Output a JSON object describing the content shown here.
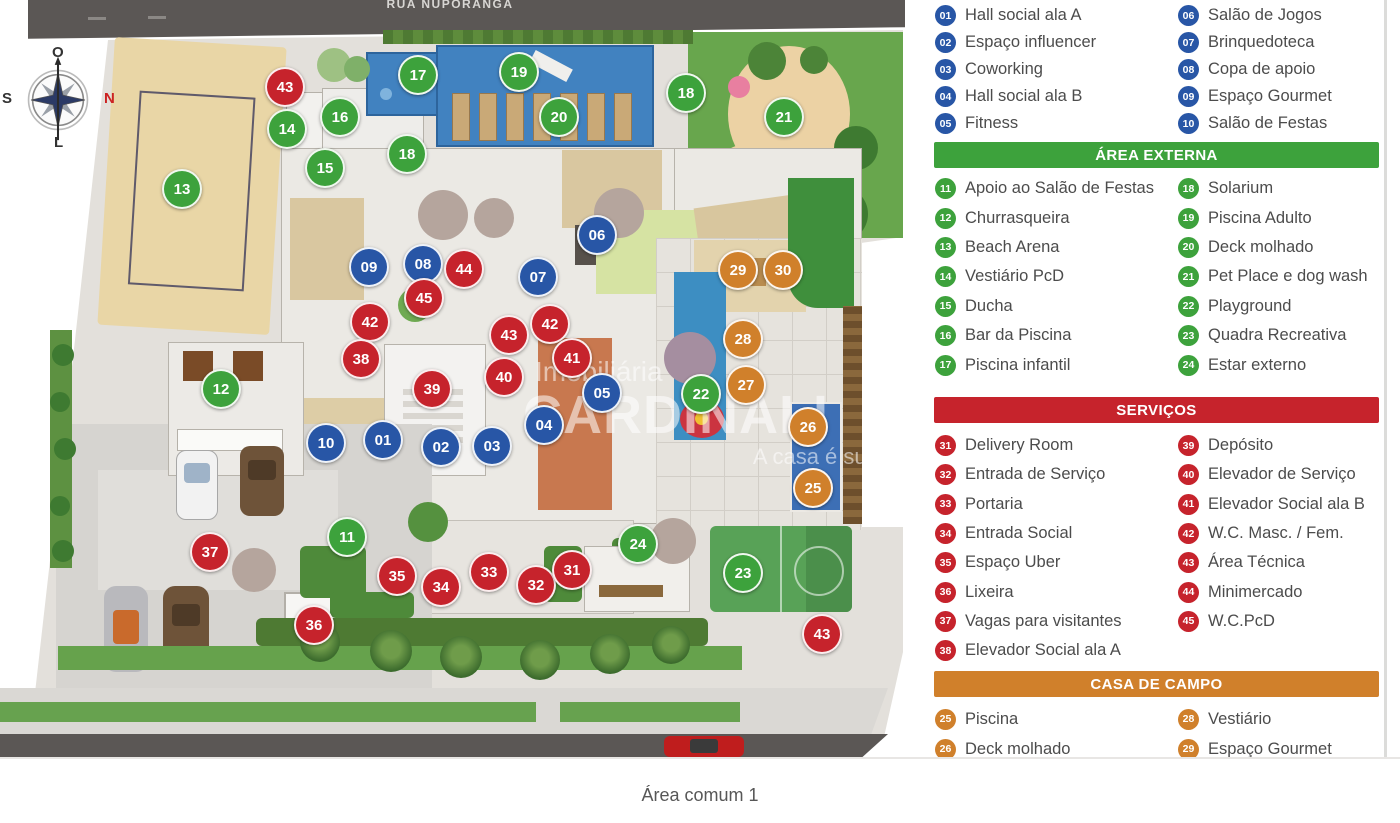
{
  "colors": {
    "blue": "#2856a6",
    "green": "#3da23c",
    "red": "#c6232c",
    "orange": "#d0802b"
  },
  "plan": {
    "street_top": "RUA NUPORANGA",
    "compass": {
      "top": "O",
      "left": "S",
      "right": "N",
      "bottom": "L"
    },
    "watermark": {
      "line1": "Imobiliária",
      "line2": "CARDINALI",
      "line3": "A casa é sua."
    },
    "markers": [
      {
        "n": "43",
        "cat": "red",
        "x": 285,
        "y": 87
      },
      {
        "n": "14",
        "cat": "green",
        "x": 287,
        "y": 129
      },
      {
        "n": "16",
        "cat": "green",
        "x": 340,
        "y": 117
      },
      {
        "n": "15",
        "cat": "green",
        "x": 325,
        "y": 168
      },
      {
        "n": "17",
        "cat": "green",
        "x": 418,
        "y": 75
      },
      {
        "n": "19",
        "cat": "green",
        "x": 519,
        "y": 72
      },
      {
        "n": "20",
        "cat": "green",
        "x": 559,
        "y": 117
      },
      {
        "n": "18",
        "cat": "green",
        "x": 407,
        "y": 154
      },
      {
        "n": "18",
        "cat": "green",
        "x": 686,
        "y": 93
      },
      {
        "n": "21",
        "cat": "green",
        "x": 784,
        "y": 117
      },
      {
        "n": "13",
        "cat": "green",
        "x": 182,
        "y": 189
      },
      {
        "n": "06",
        "cat": "blue",
        "x": 597,
        "y": 235
      },
      {
        "n": "09",
        "cat": "blue",
        "x": 369,
        "y": 267
      },
      {
        "n": "08",
        "cat": "blue",
        "x": 423,
        "y": 264
      },
      {
        "n": "44",
        "cat": "red",
        "x": 464,
        "y": 269
      },
      {
        "n": "07",
        "cat": "blue",
        "x": 538,
        "y": 277
      },
      {
        "n": "45",
        "cat": "red",
        "x": 424,
        "y": 298
      },
      {
        "n": "29",
        "cat": "orange",
        "x": 738,
        "y": 270
      },
      {
        "n": "30",
        "cat": "orange",
        "x": 783,
        "y": 270
      },
      {
        "n": "42",
        "cat": "red",
        "x": 370,
        "y": 322
      },
      {
        "n": "43",
        "cat": "red",
        "x": 509,
        "y": 335
      },
      {
        "n": "42",
        "cat": "red",
        "x": 550,
        "y": 324
      },
      {
        "n": "38",
        "cat": "red",
        "x": 361,
        "y": 359
      },
      {
        "n": "41",
        "cat": "red",
        "x": 572,
        "y": 358
      },
      {
        "n": "28",
        "cat": "orange",
        "x": 743,
        "y": 339
      },
      {
        "n": "39",
        "cat": "red",
        "x": 432,
        "y": 389
      },
      {
        "n": "40",
        "cat": "red",
        "x": 504,
        "y": 377
      },
      {
        "n": "05",
        "cat": "blue",
        "x": 602,
        "y": 393
      },
      {
        "n": "27",
        "cat": "orange",
        "x": 746,
        "y": 385
      },
      {
        "n": "22",
        "cat": "green",
        "x": 701,
        "y": 394
      },
      {
        "n": "12",
        "cat": "green",
        "x": 221,
        "y": 389
      },
      {
        "n": "26",
        "cat": "orange",
        "x": 808,
        "y": 427
      },
      {
        "n": "10",
        "cat": "blue",
        "x": 326,
        "y": 443
      },
      {
        "n": "01",
        "cat": "blue",
        "x": 383,
        "y": 440
      },
      {
        "n": "02",
        "cat": "blue",
        "x": 441,
        "y": 447
      },
      {
        "n": "03",
        "cat": "blue",
        "x": 492,
        "y": 446
      },
      {
        "n": "04",
        "cat": "blue",
        "x": 544,
        "y": 425
      },
      {
        "n": "25",
        "cat": "orange",
        "x": 813,
        "y": 488
      },
      {
        "n": "11",
        "cat": "green",
        "x": 347,
        "y": 537
      },
      {
        "n": "24",
        "cat": "green",
        "x": 638,
        "y": 544
      },
      {
        "n": "23",
        "cat": "green",
        "x": 743,
        "y": 573
      },
      {
        "n": "37",
        "cat": "red",
        "x": 210,
        "y": 552
      },
      {
        "n": "35",
        "cat": "red",
        "x": 397,
        "y": 576
      },
      {
        "n": "34",
        "cat": "red",
        "x": 441,
        "y": 587
      },
      {
        "n": "33",
        "cat": "red",
        "x": 489,
        "y": 572
      },
      {
        "n": "32",
        "cat": "red",
        "x": 536,
        "y": 585
      },
      {
        "n": "31",
        "cat": "red",
        "x": 572,
        "y": 570
      },
      {
        "n": "36",
        "cat": "red",
        "x": 314,
        "y": 625
      },
      {
        "n": "43",
        "cat": "red",
        "x": 822,
        "y": 634
      }
    ]
  },
  "legend": {
    "social_left": [
      {
        "n": "01",
        "label": "Hall social ala A"
      },
      {
        "n": "02",
        "label": "Espaço influencer"
      },
      {
        "n": "03",
        "label": "Coworking"
      },
      {
        "n": "04",
        "label": "Hall social ala B"
      },
      {
        "n": "05",
        "label": "Fitness"
      }
    ],
    "social_right": [
      {
        "n": "06",
        "label": "Salão de Jogos"
      },
      {
        "n": "07",
        "label": "Brinquedoteca"
      },
      {
        "n": "08",
        "label": "Copa de apoio"
      },
      {
        "n": "09",
        "label": "Espaço Gourmet"
      },
      {
        "n": "10",
        "label": "Salão de Festas"
      }
    ],
    "externa_header": "ÁREA EXTERNA",
    "externa_left": [
      {
        "n": "11",
        "label": "Apoio ao Salão de Festas"
      },
      {
        "n": "12",
        "label": "Churrasqueira"
      },
      {
        "n": "13",
        "label": "Beach Arena"
      },
      {
        "n": "14",
        "label": "Vestiário PcD"
      },
      {
        "n": "15",
        "label": "Ducha"
      },
      {
        "n": "16",
        "label": "Bar da Piscina"
      },
      {
        "n": "17",
        "label": "Piscina infantil"
      }
    ],
    "externa_right": [
      {
        "n": "18",
        "label": "Solarium"
      },
      {
        "n": "19",
        "label": "Piscina Adulto"
      },
      {
        "n": "20",
        "label": "Deck molhado"
      },
      {
        "n": "21",
        "label": "Pet Place e dog wash"
      },
      {
        "n": "22",
        "label": "Playground"
      },
      {
        "n": "23",
        "label": "Quadra Recreativa"
      },
      {
        "n": "24",
        "label": "Estar externo"
      }
    ],
    "servicos_header": "SERVIÇOS",
    "servicos_left": [
      {
        "n": "31",
        "label": "Delivery Room"
      },
      {
        "n": "32",
        "label": "Entrada de Serviço"
      },
      {
        "n": "33",
        "label": "Portaria"
      },
      {
        "n": "34",
        "label": "Entrada Social"
      },
      {
        "n": "35",
        "label": "Espaço Uber"
      },
      {
        "n": "36",
        "label": "Lixeira"
      },
      {
        "n": "37",
        "label": "Vagas para visitantes"
      },
      {
        "n": "38",
        "label": "Elevador Social ala A"
      }
    ],
    "servicos_right": [
      {
        "n": "39",
        "label": "Depósito"
      },
      {
        "n": "40",
        "label": "Elevador de Serviço"
      },
      {
        "n": "41",
        "label": "Elevador Social ala B"
      },
      {
        "n": "42",
        "label": "W.C. Masc. / Fem."
      },
      {
        "n": "43",
        "label": "Área Técnica"
      },
      {
        "n": "44",
        "label": "Minimercado"
      },
      {
        "n": "45",
        "label": "W.C.PcD"
      }
    ],
    "casa_header": "CASA DE CAMPO",
    "casa_left": [
      {
        "n": "25",
        "label": "Piscina"
      },
      {
        "n": "26",
        "label": "Deck molhado"
      }
    ],
    "casa_right": [
      {
        "n": "28",
        "label": "Vestiário"
      },
      {
        "n": "29",
        "label": "Espaço Gourmet"
      }
    ]
  },
  "caption": "Área comum 1"
}
